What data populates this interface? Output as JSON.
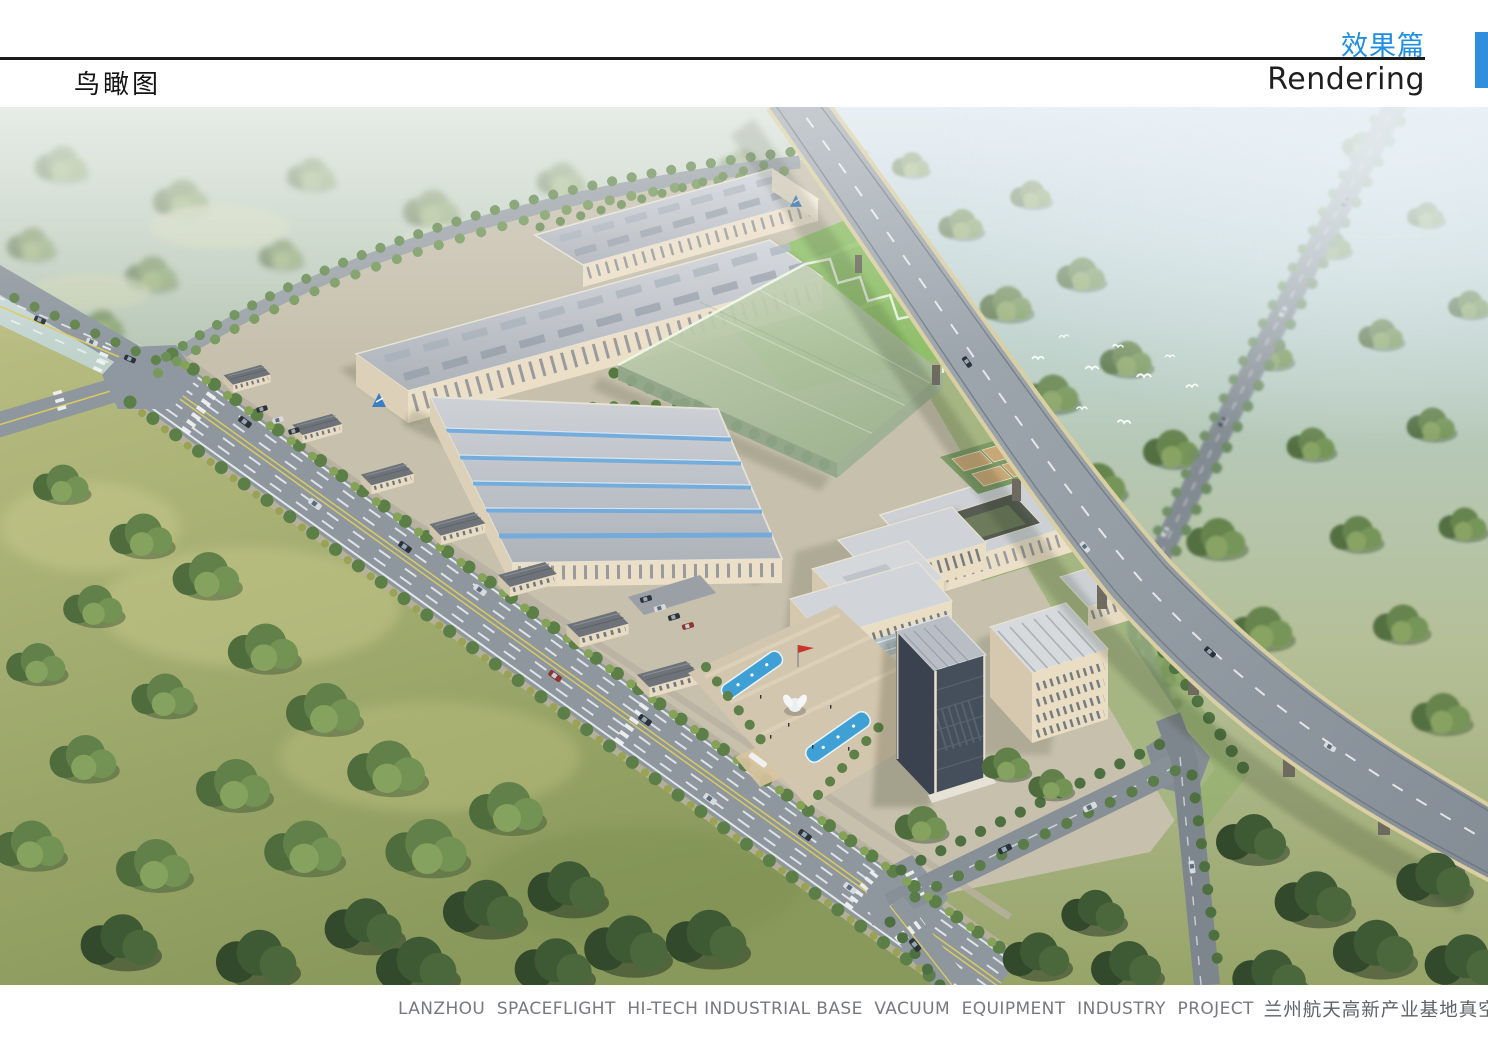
{
  "header": {
    "section_title_cn": "效果篇",
    "section_title_en": "Rendering",
    "page_label": "鸟瞰图"
  },
  "footer": {
    "caption_en": "LANZHOU  SPACEFLIGHT  HI-TECH INDUSTRIAL BASE  VACUUM  EQUIPMENT  INDUSTRY  PROJECT",
    "caption_cn": "兰州航天高新产业基地真空装备产业园项目"
  },
  "colors": {
    "accent_blue": "#2F8FDC",
    "title_blue": "#1E8FE0",
    "caption_gray": "#77797C",
    "rule_black": "#1B1B1B"
  },
  "image": {
    "alt": "Aerial bird's-eye rendering of the vacuum equipment industrial park: factory halls, green glass building, office towers, plaza with fountains, boulevard and elevated highway among fields and trees"
  }
}
